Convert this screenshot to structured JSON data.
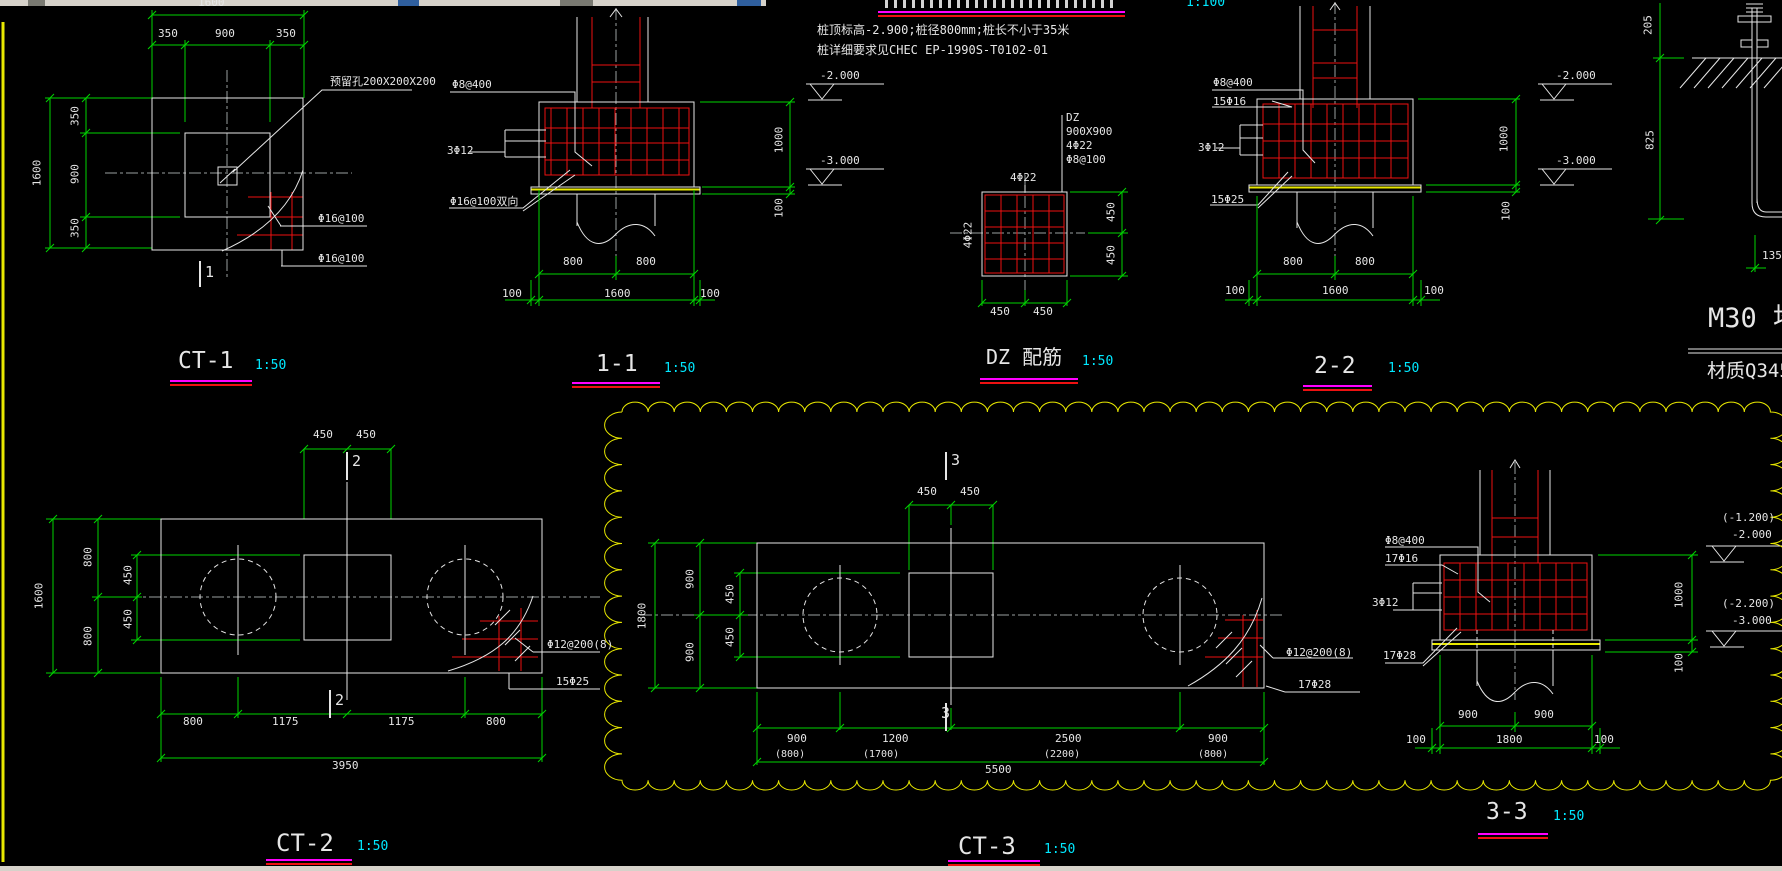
{
  "colors": {
    "text": "#e6e6e6",
    "white": "#e6e6e6",
    "green": "#00d400",
    "red": "#ee1111",
    "yellow": "#e8e800",
    "magenta": "#ff00ff",
    "cyan": "#00e8ff",
    "gray": "#9aa0a0",
    "chrome": "#d6d2ca",
    "chrome_dark": "#7a7a72",
    "chrome_blue": "#2f5f9e"
  },
  "figures": [
    {
      "name": "ct1",
      "title": "CT-1",
      "scale": "1:50"
    },
    {
      "name": "s11",
      "title": "1-1",
      "scale": "1:50"
    },
    {
      "name": "dz",
      "title": "DZ 配筋",
      "scale": "1:50"
    },
    {
      "name": "s22",
      "title": "2-2",
      "scale": "1:50"
    },
    {
      "name": "ct2",
      "title": "CT-2",
      "scale": "1:50"
    },
    {
      "name": "ct3",
      "title": "CT-3",
      "scale": "1:50"
    },
    {
      "name": "s33",
      "title": "3-3",
      "scale": "1:50"
    },
    {
      "name": "bolt",
      "title": "M30 地脚",
      "scale": ""
    }
  ],
  "texts": {
    "notes": [
      {
        "n": "scale-1-100",
        "t": "1:100",
        "x": 1186,
        "y": -4,
        "s": 13,
        "c": "cyan"
      },
      {
        "n": "note-line-1",
        "t": "桩顶标高-2.900;桩径800mm;桩长不小于35米",
        "x": 817,
        "y": 24,
        "s": 12
      },
      {
        "n": "note-line-2",
        "t": "桩详细要求见CHEC EP-1990S-T0102-01",
        "x": 817,
        "y": 44,
        "s": 12
      }
    ],
    "ct1": [
      {
        "n": "dim-top-total",
        "t": "1600",
        "x": 198,
        "y": -3
      },
      {
        "n": "dim-top-350a",
        "t": "350",
        "x": 158,
        "y": 28
      },
      {
        "n": "dim-top-900",
        "t": "900",
        "x": 215,
        "y": 28
      },
      {
        "n": "dim-top-350b",
        "t": "350",
        "x": 276,
        "y": 28
      },
      {
        "n": "dim-left-total",
        "t": "1600",
        "x": 37,
        "y": 173,
        "r": 1
      },
      {
        "n": "dim-left-350a",
        "t": "350",
        "x": 75,
        "y": 116,
        "r": 1
      },
      {
        "n": "dim-left-900",
        "t": "900",
        "x": 75,
        "y": 174,
        "r": 1
      },
      {
        "n": "dim-left-350b",
        "t": "350",
        "x": 75,
        "y": 228,
        "r": 1
      },
      {
        "n": "label-hole",
        "t": "预留孔200X200X200",
        "x": 330,
        "y": 76
      },
      {
        "n": "label-rebar-1",
        "t": "Φ16@100",
        "x": 318,
        "y": 213
      },
      {
        "n": "label-rebar-2",
        "t": "Φ16@100",
        "x": 318,
        "y": 253
      },
      {
        "n": "section-mark",
        "t": "1",
        "x": 205,
        "y": 265,
        "s": 15
      },
      {
        "n": "title",
        "t": "CT-1",
        "x": 178,
        "y": 350,
        "s": 23
      },
      {
        "n": "scale",
        "t": "1:50",
        "x": 255,
        "y": 359,
        "s": 13,
        "c": "cyan"
      }
    ],
    "s11": [
      {
        "n": "label-stirrup",
        "t": "Φ8@400",
        "x": 452,
        "y": 79
      },
      {
        "n": "label-3d12",
        "t": "3Φ12",
        "x": 447,
        "y": 145
      },
      {
        "n": "label-bottom",
        "t": "Φ16@100双向",
        "x": 450,
        "y": 196
      },
      {
        "n": "dim-800a",
        "t": "800",
        "x": 563,
        "y": 256
      },
      {
        "n": "dim-800b",
        "t": "800",
        "x": 636,
        "y": 256
      },
      {
        "n": "dim-100a",
        "t": "100",
        "x": 502,
        "y": 288
      },
      {
        "n": "dim-1600",
        "t": "1600",
        "x": 604,
        "y": 288
      },
      {
        "n": "dim-100b",
        "t": "100",
        "x": 700,
        "y": 288
      },
      {
        "n": "dim-1000",
        "t": "1000",
        "x": 779,
        "y": 140,
        "r": 1
      },
      {
        "n": "dim-100r",
        "t": "100",
        "x": 779,
        "y": 208,
        "r": 1
      },
      {
        "n": "elev-2000",
        "t": "-2.000",
        "x": 820,
        "y": 70
      },
      {
        "n": "elev-3000",
        "t": "-3.000",
        "x": 820,
        "y": 155
      },
      {
        "n": "title",
        "t": "1-1",
        "x": 596,
        "y": 353,
        "s": 23
      },
      {
        "n": "scale",
        "t": "1:50",
        "x": 664,
        "y": 362,
        "s": 13,
        "c": "cyan"
      }
    ],
    "dz": [
      {
        "n": "callout-name",
        "t": "DZ",
        "x": 1066,
        "y": 112
      },
      {
        "n": "callout-size",
        "t": "900X900",
        "x": 1066,
        "y": 126
      },
      {
        "n": "callout-bars",
        "t": "4Φ22",
        "x": 1066,
        "y": 140
      },
      {
        "n": "callout-stirrup",
        "t": "Φ8@100",
        "x": 1066,
        "y": 154
      },
      {
        "n": "top-bars",
        "t": "4Φ22",
        "x": 1010,
        "y": 172
      },
      {
        "n": "left-bars",
        "t": "4Φ22",
        "x": 968,
        "y": 235,
        "r": 1
      },
      {
        "n": "dim-450-r1",
        "t": "450",
        "x": 1111,
        "y": 212,
        "r": 1
      },
      {
        "n": "dim-450-r2",
        "t": "450",
        "x": 1111,
        "y": 255,
        "r": 1
      },
      {
        "n": "dim-450-b1",
        "t": "450",
        "x": 990,
        "y": 306
      },
      {
        "n": "dim-450-b2",
        "t": "450",
        "x": 1033,
        "y": 306
      },
      {
        "n": "title",
        "t": "DZ 配筋",
        "x": 986,
        "y": 347,
        "s": 20
      },
      {
        "n": "scale",
        "t": "1:50",
        "x": 1082,
        "y": 355,
        "s": 13,
        "c": "cyan"
      }
    ],
    "s22": [
      {
        "n": "label-stirrup",
        "t": "Φ8@400",
        "x": 1213,
        "y": 77
      },
      {
        "n": "label-top",
        "t": "15Φ16",
        "x": 1213,
        "y": 96
      },
      {
        "n": "label-3d12",
        "t": "3Φ12",
        "x": 1198,
        "y": 142
      },
      {
        "n": "label-bottom",
        "t": "15Φ25",
        "x": 1211,
        "y": 194
      },
      {
        "n": "dim-800a",
        "t": "800",
        "x": 1283,
        "y": 256
      },
      {
        "n": "dim-800b",
        "t": "800",
        "x": 1355,
        "y": 256
      },
      {
        "n": "dim-100a",
        "t": "100",
        "x": 1225,
        "y": 285
      },
      {
        "n": "dim-1600",
        "t": "1600",
        "x": 1322,
        "y": 285
      },
      {
        "n": "dim-100b",
        "t": "100",
        "x": 1424,
        "y": 285
      },
      {
        "n": "dim-1000",
        "t": "1000",
        "x": 1504,
        "y": 139,
        "r": 1
      },
      {
        "n": "dim-100r",
        "t": "100",
        "x": 1506,
        "y": 211,
        "r": 1
      },
      {
        "n": "elev-2000",
        "t": "-2.000",
        "x": 1556,
        "y": 70
      },
      {
        "n": "elev-3000",
        "t": "-3.000",
        "x": 1556,
        "y": 155
      },
      {
        "n": "title",
        "t": "2-2",
        "x": 1314,
        "y": 355,
        "s": 23
      },
      {
        "n": "scale",
        "t": "1:50",
        "x": 1388,
        "y": 362,
        "s": 13,
        "c": "cyan"
      }
    ],
    "bolt": [
      {
        "n": "dim-205",
        "t": "205",
        "x": 1648,
        "y": 25,
        "r": 1
      },
      {
        "n": "dim-825",
        "t": "825",
        "x": 1650,
        "y": 140,
        "r": 1
      },
      {
        "n": "dim-135",
        "t": "135",
        "x": 1762,
        "y": 250
      },
      {
        "n": "title",
        "t": "M30 地脚",
        "x": 1708,
        "y": 305,
        "s": 27
      },
      {
        "n": "material",
        "t": "材质Q345",
        "x": 1707,
        "y": 362,
        "s": 19
      }
    ],
    "ct2": [
      {
        "n": "dim-left-total",
        "t": "1600",
        "x": 39,
        "y": 596,
        "r": 1
      },
      {
        "n": "dim-left-800a",
        "t": "800",
        "x": 88,
        "y": 557,
        "r": 1
      },
      {
        "n": "dim-left-800b",
        "t": "800",
        "x": 88,
        "y": 636,
        "r": 1
      },
      {
        "n": "dim-left-450a",
        "t": "450",
        "x": 128,
        "y": 575,
        "r": 1
      },
      {
        "n": "dim-left-450b",
        "t": "450",
        "x": 128,
        "y": 619,
        "r": 1
      },
      {
        "n": "dim-top-450a",
        "t": "450",
        "x": 313,
        "y": 429
      },
      {
        "n": "dim-top-450b",
        "t": "450",
        "x": 356,
        "y": 429
      },
      {
        "n": "section-top",
        "t": "2",
        "x": 352,
        "y": 454,
        "s": 15
      },
      {
        "n": "section-bottom",
        "t": "2",
        "x": 335,
        "y": 693,
        "s": 15
      },
      {
        "n": "label-stirrup",
        "t": "Φ12@200(8)",
        "x": 547,
        "y": 639
      },
      {
        "n": "label-bottom",
        "t": "15Φ25",
        "x": 556,
        "y": 676
      },
      {
        "n": "dim-800c",
        "t": "800",
        "x": 183,
        "y": 716
      },
      {
        "n": "dim-1175a",
        "t": "1175",
        "x": 272,
        "y": 716
      },
      {
        "n": "dim-1175b",
        "t": "1175",
        "x": 388,
        "y": 716
      },
      {
        "n": "dim-800d",
        "t": "800",
        "x": 486,
        "y": 716
      },
      {
        "n": "dim-total",
        "t": "3950",
        "x": 332,
        "y": 760
      },
      {
        "n": "title",
        "t": "CT-2",
        "x": 276,
        "y": 831,
        "s": 24
      },
      {
        "n": "scale",
        "t": "1:50",
        "x": 357,
        "y": 840,
        "s": 13,
        "c": "cyan"
      }
    ],
    "ct3": [
      {
        "n": "dim-left-total",
        "t": "1800",
        "x": 642,
        "y": 616,
        "r": 1
      },
      {
        "n": "dim-left-900a",
        "t": "900",
        "x": 690,
        "y": 579,
        "r": 1
      },
      {
        "n": "dim-left-900b",
        "t": "900",
        "x": 690,
        "y": 652,
        "r": 1
      },
      {
        "n": "dim-left-450a",
        "t": "450",
        "x": 730,
        "y": 594,
        "r": 1
      },
      {
        "n": "dim-left-450b",
        "t": "450",
        "x": 730,
        "y": 637,
        "r": 1
      },
      {
        "n": "dim-top-450a",
        "t": "450",
        "x": 917,
        "y": 486
      },
      {
        "n": "dim-top-450b",
        "t": "450",
        "x": 960,
        "y": 486
      },
      {
        "n": "section-top",
        "t": "3",
        "x": 951,
        "y": 453,
        "s": 15
      },
      {
        "n": "section-bottom",
        "t": "3",
        "x": 941,
        "y": 706,
        "s": 15
      },
      {
        "n": "label-stirrup",
        "t": "Φ12@200(8)",
        "x": 1286,
        "y": 647
      },
      {
        "n": "label-bottom",
        "t": "17Φ28",
        "x": 1298,
        "y": 679
      },
      {
        "n": "dim-900a",
        "t": "900",
        "x": 787,
        "y": 733
      },
      {
        "n": "dim-1200",
        "t": "1200",
        "x": 882,
        "y": 733
      },
      {
        "n": "dim-2500",
        "t": "2500",
        "x": 1055,
        "y": 733
      },
      {
        "n": "dim-900b",
        "t": "900",
        "x": 1208,
        "y": 733
      },
      {
        "n": "dim-800p1",
        "t": "(800)",
        "x": 775,
        "y": 750,
        "s": 10
      },
      {
        "n": "dim-1700p",
        "t": "(1700)",
        "x": 863,
        "y": 750,
        "s": 10
      },
      {
        "n": "dim-2200p",
        "t": "(2200)",
        "x": 1044,
        "y": 750,
        "s": 10
      },
      {
        "n": "dim-800p2",
        "t": "(800)",
        "x": 1198,
        "y": 750,
        "s": 10
      },
      {
        "n": "dim-total",
        "t": "5500",
        "x": 985,
        "y": 764
      },
      {
        "n": "title",
        "t": "CT-3",
        "x": 958,
        "y": 834,
        "s": 24
      },
      {
        "n": "scale",
        "t": "1:50",
        "x": 1044,
        "y": 843,
        "s": 13,
        "c": "cyan"
      }
    ],
    "s33": [
      {
        "n": "label-stirrup",
        "t": "Φ8@400",
        "x": 1385,
        "y": 535
      },
      {
        "n": "label-top",
        "t": "17Φ16",
        "x": 1385,
        "y": 553
      },
      {
        "n": "label-3d12",
        "t": "3Φ12",
        "x": 1372,
        "y": 597
      },
      {
        "n": "label-bottom",
        "t": "17Φ28",
        "x": 1383,
        "y": 650
      },
      {
        "n": "dim-900a",
        "t": "900",
        "x": 1458,
        "y": 709
      },
      {
        "n": "dim-900b",
        "t": "900",
        "x": 1534,
        "y": 709
      },
      {
        "n": "dim-100a",
        "t": "100",
        "x": 1406,
        "y": 734
      },
      {
        "n": "dim-1800",
        "t": "1800",
        "x": 1496,
        "y": 734
      },
      {
        "n": "dim-100b",
        "t": "100",
        "x": 1594,
        "y": 734
      },
      {
        "n": "dim-1000",
        "t": "1000",
        "x": 1679,
        "y": 595,
        "r": 1
      },
      {
        "n": "dim-100r",
        "t": "100",
        "x": 1679,
        "y": 663,
        "r": 1
      },
      {
        "n": "elev-a1",
        "t": "(-1.200)",
        "x": 1722,
        "y": 512
      },
      {
        "n": "elev-a2",
        "t": "-2.000",
        "x": 1732,
        "y": 529
      },
      {
        "n": "elev-b1",
        "t": "(-2.200)",
        "x": 1722,
        "y": 598
      },
      {
        "n": "elev-b2",
        "t": "-3.000",
        "x": 1732,
        "y": 615
      },
      {
        "n": "title",
        "t": "3-3",
        "x": 1486,
        "y": 801,
        "s": 23
      },
      {
        "n": "scale",
        "t": "1:50",
        "x": 1553,
        "y": 810,
        "s": 13,
        "c": "cyan"
      }
    ]
  }
}
